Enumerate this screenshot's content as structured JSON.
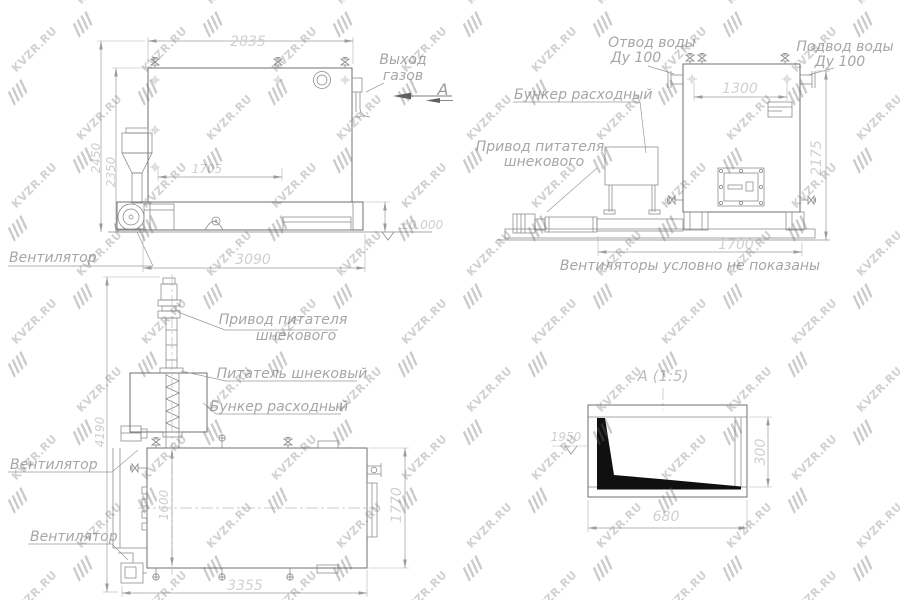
{
  "watermark": {
    "text": "KVZR.RU"
  },
  "side_view": {
    "labels": {
      "gas_outlet_line1": "Выход",
      "gas_outlet_line2": "газов",
      "section_letter": "А",
      "fan": "Вентилятор",
      "level_mark": "±0.000"
    },
    "dims": {
      "top_width": "2835",
      "grate_length": "1705",
      "base_length": "3090",
      "height_outer": "2450",
      "height_inner": "2350"
    }
  },
  "front_view": {
    "labels": {
      "water_outlet_line1": "Отвод воды",
      "water_outlet_line2": "Ду 100",
      "water_inlet_line1": "Подвод воды",
      "water_inlet_line2": "Ду 100",
      "hopper": "Бункер расходный",
      "feeder_drive_line1": "Привод питателя",
      "feeder_drive_line2": "шнекового",
      "note": "Вентиляторы условно не показаны"
    },
    "dims": {
      "top_width": "1300",
      "height": "2175",
      "base_width": "1700"
    }
  },
  "plan_view": {
    "labels": {
      "feeder_drive_line1": "Привод питателя",
      "feeder_drive_line2": "шнекового",
      "screw_feeder": "Питатель шнековый",
      "hopper": "Бункер расходный",
      "fan_top": "Вентилятор",
      "fan_bottom": "Вентилятор"
    },
    "dims": {
      "total_length": "4190",
      "feeder_offset": "1600",
      "width": "1770",
      "base_length": "3355"
    }
  },
  "detail_view": {
    "title": "А  (1:5)",
    "dims": {
      "width": "680",
      "height": "300",
      "level": "1950"
    }
  }
}
